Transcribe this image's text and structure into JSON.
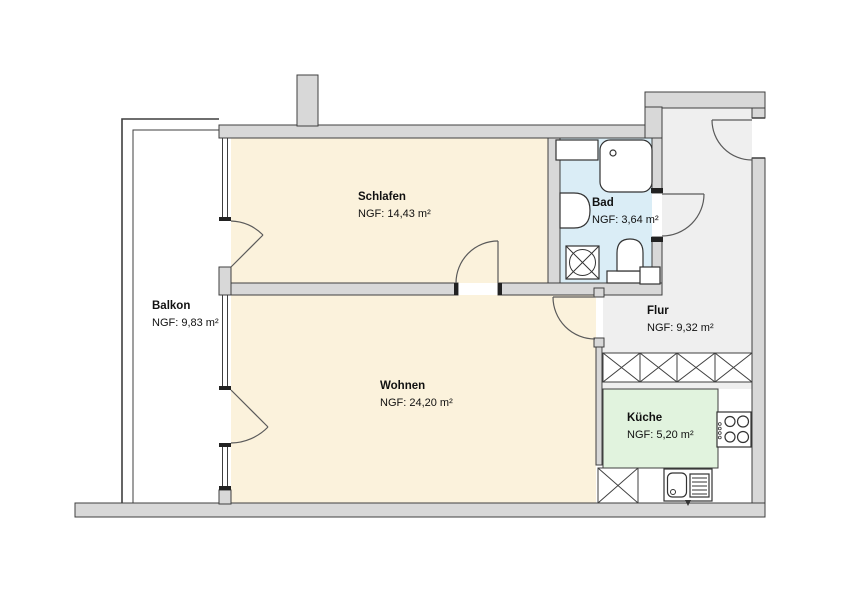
{
  "plan": {
    "type": "apartment-floor-plan",
    "rooms": [
      {
        "id": "balkon",
        "name": "Balkon",
        "area": "NGF: 9,83 m²",
        "floor_color": "#ffffff"
      },
      {
        "id": "schlafen",
        "name": "Schlafen",
        "area": "NGF: 14,43 m²",
        "floor_color": "#fbf2dc"
      },
      {
        "id": "bad",
        "name": "Bad",
        "area": "NGF: 3,64 m²",
        "floor_color": "#daedf6"
      },
      {
        "id": "flur",
        "name": "Flur",
        "area": "NGF: 9,32 m²",
        "floor_color": "#efefef"
      },
      {
        "id": "wohnen",
        "name": "Wohnen",
        "area": "NGF: 24,20 m²",
        "floor_color": "#fbf2dc"
      },
      {
        "id": "kueche",
        "name": "Küche",
        "area": "NGF: 5,20 m²",
        "floor_color": "#e1f3de"
      }
    ],
    "fixtures": [
      "shower",
      "bathroom-cabinet",
      "washbasin",
      "washing-machine",
      "toilet",
      "shaft",
      "built-in-wardrobe",
      "tall-cabinet",
      "kitchen-sink",
      "stove"
    ],
    "colors": {
      "wall_fill": "#d8d8d8",
      "wall_outline": "#3f3f3f",
      "door_line": "#5a5a5a",
      "background": "#ffffff"
    }
  }
}
